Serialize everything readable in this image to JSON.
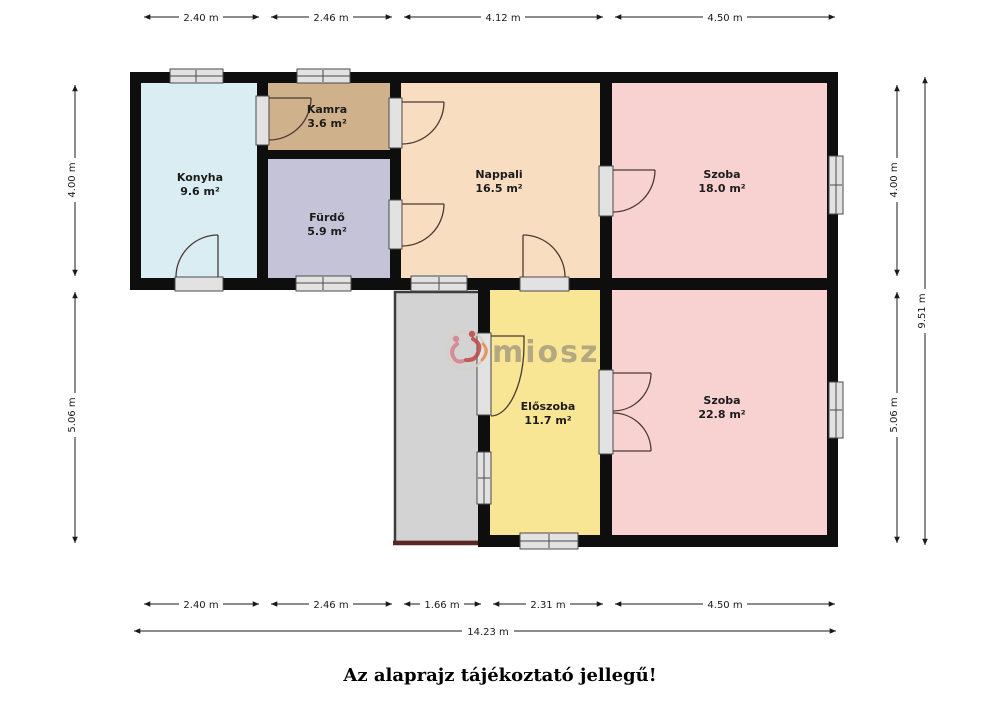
{
  "caption": "Az alaprajz tájékoztató jellegű!",
  "watermark": {
    "brand": "miosz"
  },
  "rooms": [
    {
      "id": "konyha",
      "name": "Konyha",
      "area": "9.6 m²"
    },
    {
      "id": "kamra",
      "name": "Kamra",
      "area": "3.6 m²"
    },
    {
      "id": "furdo",
      "name": "Fürdő",
      "area": "5.9 m²"
    },
    {
      "id": "nappali",
      "name": "Nappali",
      "area": "16.5 m²"
    },
    {
      "id": "szoba-1",
      "name": "Szoba",
      "area": "18.0 m²"
    },
    {
      "id": "eloszoba",
      "name": "Előszoba",
      "area": "11.7 m²"
    },
    {
      "id": "szoba-2",
      "name": "Szoba",
      "area": "22.8 m²"
    }
  ],
  "dimensions": {
    "top": [
      "2.40 m",
      "2.46 m",
      "4.12 m",
      "4.50 m"
    ],
    "bottom": [
      "2.40 m",
      "2.46 m",
      "1.66 m",
      "2.31 m",
      "4.50 m"
    ],
    "bottom_total": "14.23 m",
    "left": [
      "4.00 m",
      "5.06 m"
    ],
    "right": [
      "4.00 m",
      "5.06 m"
    ],
    "right_total": "9.51 m"
  },
  "colors": {
    "wall": "#0e0e0e",
    "kitchen": "#d9edf2",
    "pantry": "#cfb28c",
    "bathroom": "#c5c3d8",
    "living": "#f9ddc1",
    "room_pink": "#f7d2d0",
    "hallway": "#f9e695",
    "terrace": "#d3d3d3",
    "terrace_border": "#5a2822",
    "watermark_text": "#8a8173",
    "logo_pink": "#d87f8f",
    "logo_red": "#bf4747",
    "logo_orange": "#e08a4a",
    "logo_ring": "#d8d0c4"
  }
}
